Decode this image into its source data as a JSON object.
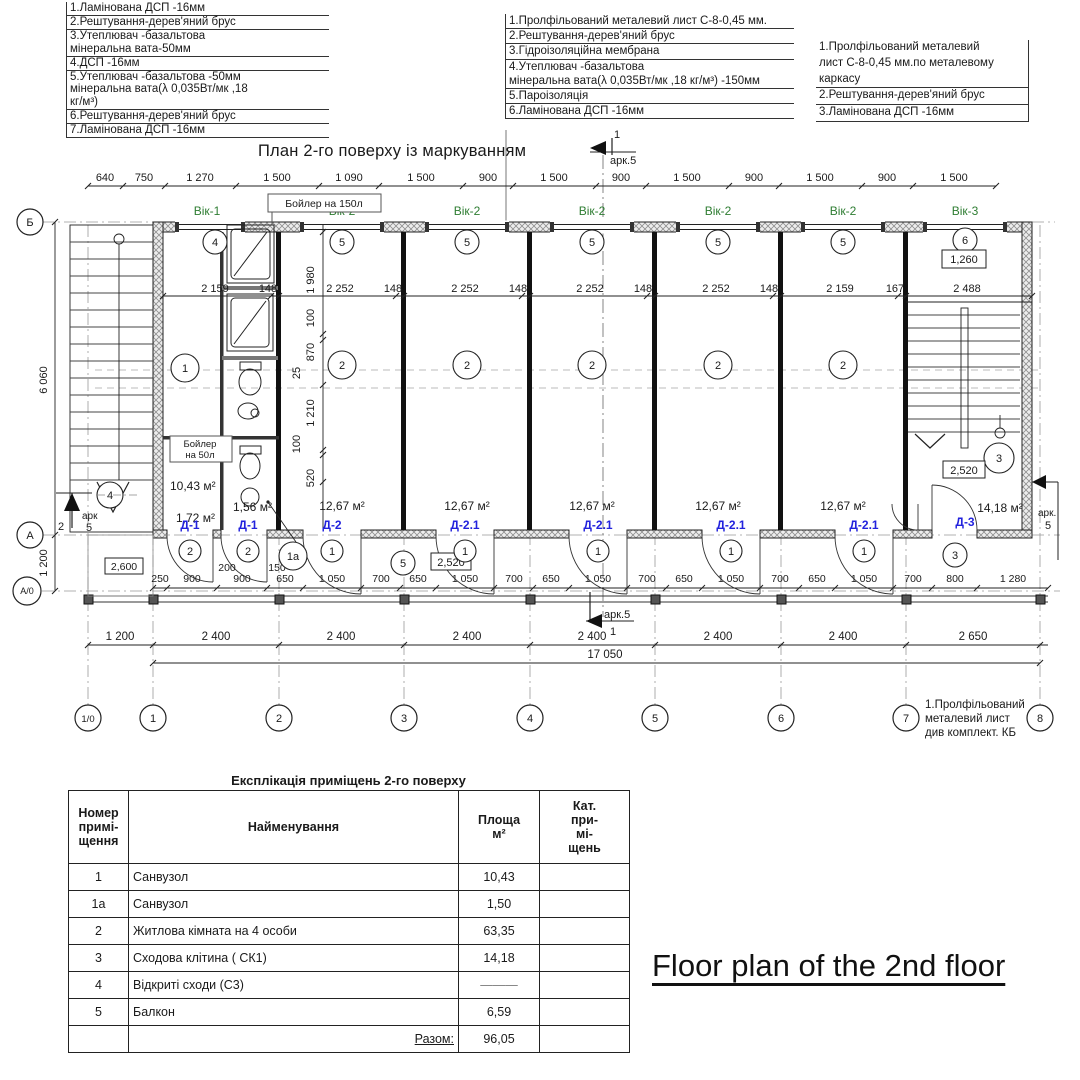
{
  "annotations": {
    "left": [
      "1.Ламінована ДСП -16мм",
      "2.Рештування-дерев'яний брус",
      "3.Утеплювач -базальтова",
      "мінеральна вата-50мм",
      "4.ДСП -16мм",
      "5.Утеплювач -базальтова -50мм",
      "мінеральна вата(λ 0,035Вт/мк ,18",
      "кг/м³)",
      "6.Рештування-дерев'яний брус",
      "7.Ламінована ДСП -16мм"
    ],
    "middle": [
      "1.Пролфільований металевий лист С-8-0,45 мм.",
      "2.Рештування-дерев'яний брус",
      "3.Гідроізоляційна мембрана",
      "4.Утеплювач -базальтова",
      "мінеральна вата(λ 0,035Вт/мк ,18 кг/м³) -150мм",
      "5.Пароізоляція",
      "6.Ламінована ДСП -16мм"
    ],
    "right": [
      "1.Пролфільований металевий",
      "лист С-8-0,45 мм.по металевому",
      "каркасу",
      "2.Рештування-дерев'яний брус",
      "3.Ламінована ДСП -16мм"
    ],
    "bottom_right": [
      "1.Пролфільований",
      "металевий лист",
      "див комплект. КБ"
    ]
  },
  "plan": {
    "title": "План 2-го поверху із маркуванням",
    "boiler150": "Бойлер на 150л",
    "boiler50a": "Бойлер",
    "boiler50b": "на 50л",
    "top_dims": [
      "640",
      "750",
      "1 270",
      "1 500",
      "1 090",
      "1 500",
      "900",
      "1 500",
      "900",
      "1 500",
      "900",
      "1 500",
      "900",
      "1 500"
    ],
    "windows": [
      "Вік-1",
      "Вік-2",
      "Вік-2",
      "Вік-2",
      "Вік-2",
      "Вік-2",
      "Вік-3"
    ],
    "mid_dims": [
      "2 159",
      "148",
      "2 252",
      "148",
      "2 252",
      "148",
      "2 252",
      "148",
      "2 252",
      "148",
      "2 159",
      "167",
      "2 488"
    ],
    "vert_outer": [
      "6 060",
      "1 200"
    ],
    "vert_chain": [
      "1 980",
      "100",
      "870",
      "25",
      "1 210",
      "100",
      "520"
    ],
    "boxed": {
      "b2600": "2,600",
      "b2520a": "2,520",
      "b2520b": "2,520",
      "b1260": "1,260"
    },
    "areas": {
      "r1": "10,43 м²",
      "r172": "1,72 м²",
      "r156": "1,56 м²",
      "r2": "12,67 м²",
      "r3": "14,18 м²"
    },
    "rooms": {
      "n1": "1",
      "n1a": "1a",
      "n2": "2",
      "n3": "3",
      "n4": "4",
      "n5": "5",
      "n6": "6"
    },
    "doors": {
      "d1": "Д-1",
      "d2": "Д-2",
      "d21": "Д-2.1",
      "d3": "Д-3"
    },
    "small_dims": [
      "200",
      "150"
    ],
    "inner_dims": [
      "250",
      "900",
      "900",
      "650",
      "1 050",
      "700",
      "650",
      "1 050",
      "700",
      "650",
      "1 050",
      "700",
      "650",
      "1 050",
      "700",
      "650",
      "1 050",
      "700",
      "800",
      "1 280"
    ],
    "bottom_dims": [
      "1 200",
      "2 400",
      "2 400",
      "2 400",
      "2 400",
      "2 400",
      "2 400",
      "2 650"
    ],
    "total_dim": "17 050",
    "axes_h": [
      "1/0",
      "1",
      "2",
      "3",
      "4",
      "5",
      "6",
      "7",
      "8"
    ],
    "axes_v": [
      "Б",
      "А",
      "А/0"
    ],
    "refs": {
      "ark5": "арк.5",
      "ark": "арк",
      "ark_dot": "арк.",
      "n5": "5",
      "n1": "1",
      "n2": "2"
    }
  },
  "table": {
    "title": "Експлікація приміщень 2-го поверху",
    "h1a": "Номер",
    "h1b": "примі-",
    "h1c": "щення",
    "h2": "Найменування",
    "h3a": "Площа",
    "h3b": "м²",
    "h4a": "Кат.",
    "h4b": "при-",
    "h4c": "мі-",
    "h4d": "щень",
    "rows": [
      [
        "1",
        "Санвузол",
        "10,43"
      ],
      [
        "1a",
        "Санвузол",
        "1,50"
      ],
      [
        "2",
        "Житлова кімната на 4 особи",
        "63,35"
      ],
      [
        "3",
        "Сходова клітина ( СК1)",
        "14,18"
      ],
      [
        "4",
        "Відкриті сходи (С3)",
        "———"
      ],
      [
        "5",
        "Балкон",
        "6,59"
      ]
    ],
    "total_label": "Разом:",
    "total_value": "96,05"
  },
  "caption": "Floor plan of the 2nd floor",
  "colors": {
    "window_green": "#2e7d32",
    "door_blue": "#2222dd"
  }
}
